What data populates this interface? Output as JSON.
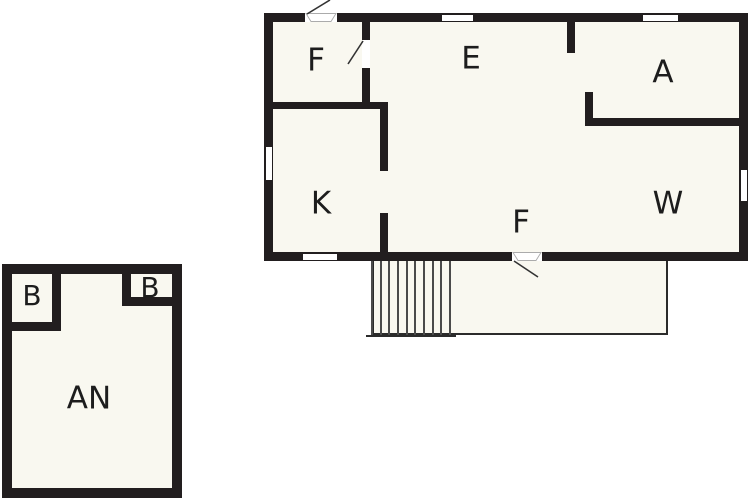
{
  "diagram": {
    "type": "floor-plan",
    "background": "#ffffff"
  },
  "colors": {
    "page_bg": "#ffffff",
    "wall": "#221e1f",
    "room_fill": "#f9f8f0",
    "label": "#1d1d1d",
    "stair_line": "#4b4b4b",
    "deck_outline": "#2b2b2b",
    "door_leaf_outline": "#ababab",
    "door_swing": "#333333"
  },
  "main_building": {
    "rooms": {
      "f_top": "F",
      "e": "E",
      "a": "A",
      "k": "K",
      "w": "W"
    },
    "entrance_label": "F"
  },
  "deck": {
    "stair_line_count": 10
  },
  "annex": {
    "rooms": {
      "b_left": "B",
      "b_right": "B",
      "an": "AN"
    }
  }
}
